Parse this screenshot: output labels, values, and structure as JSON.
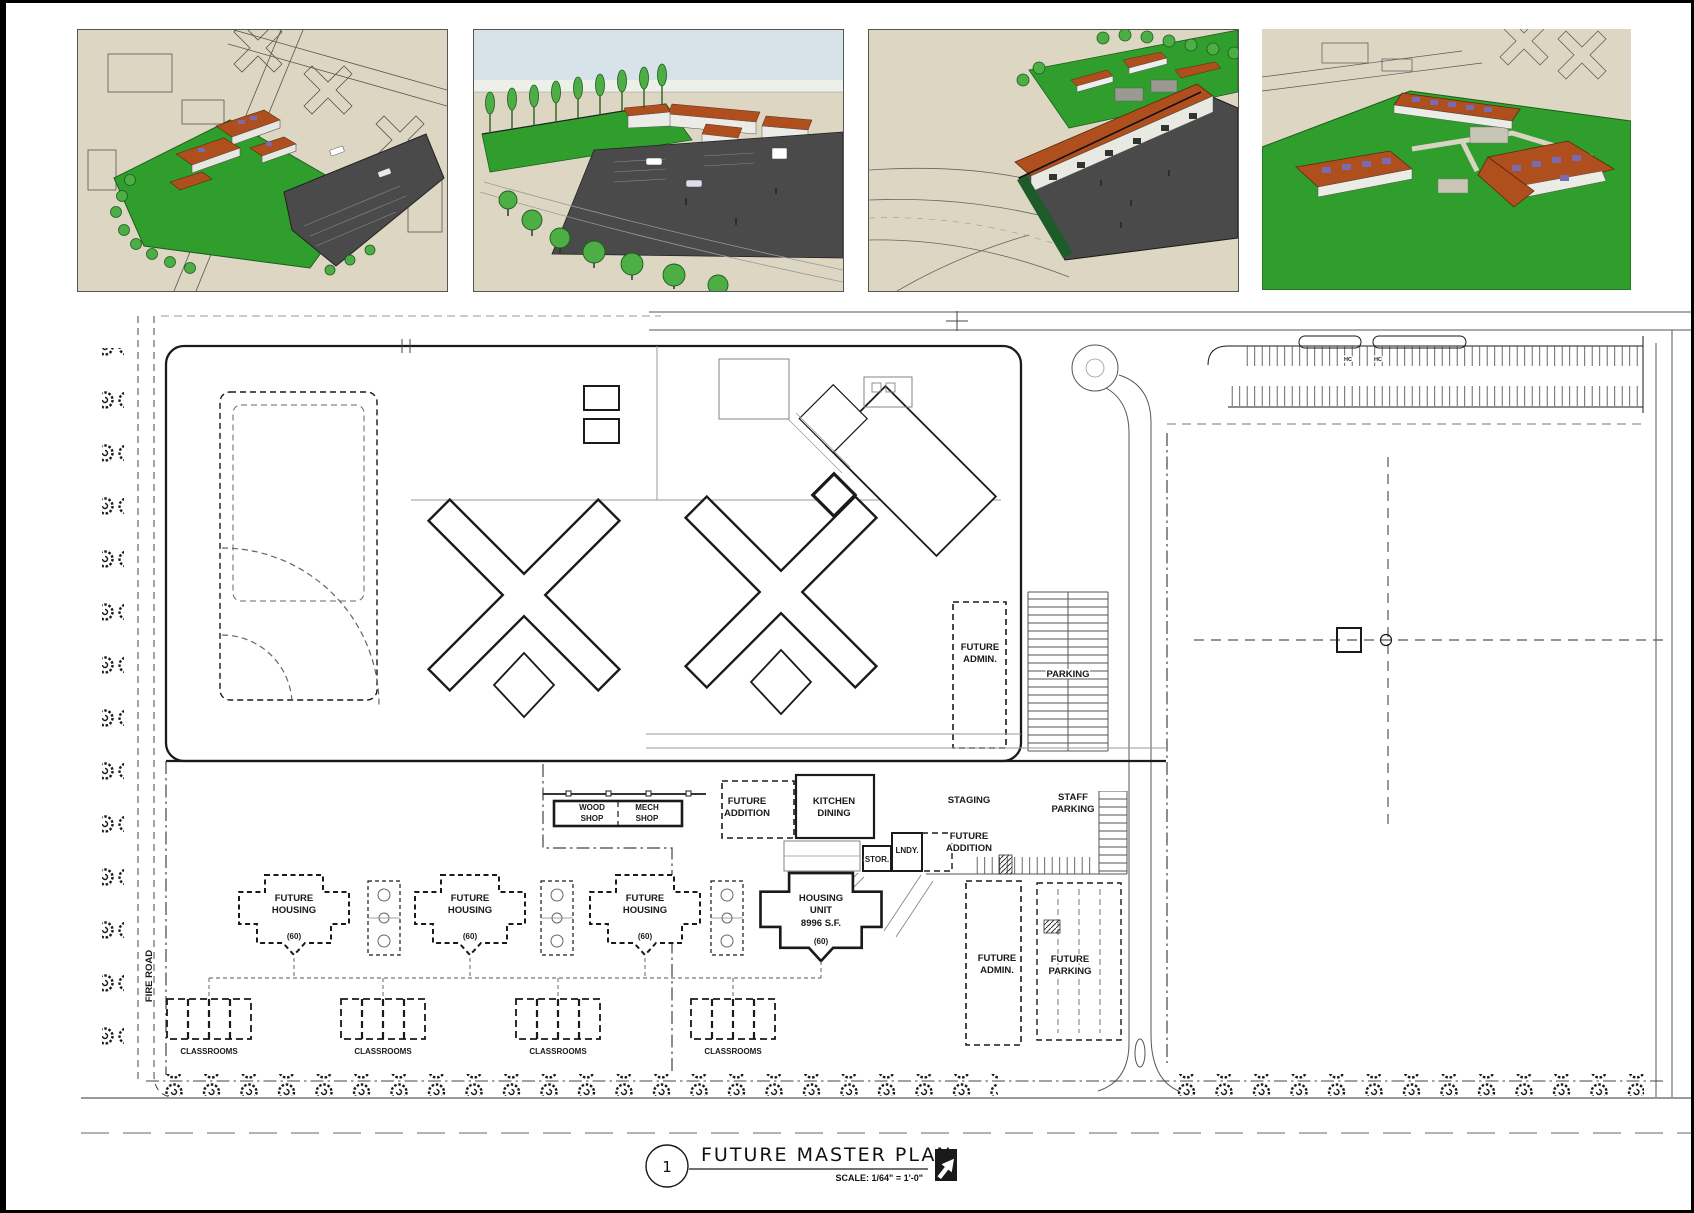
{
  "title_block": {
    "sheet_number": "1",
    "title": "FUTURE MASTER PLAN",
    "scale": "SCALE: 1/64\" = 1'-0\""
  },
  "plan": {
    "words": {
      "future": "FUTURE",
      "admin": "ADMIN.",
      "parking": "PARKING",
      "wood": "WOOD",
      "mech": "MECH",
      "shop": "SHOP",
      "addition": "ADDITION",
      "kitchen": "KITCHEN",
      "dining": "DINING",
      "staging": "STAGING",
      "staff": "STAFF",
      "laundry": "LNDY.",
      "storage": "STOR.",
      "housing": "HOUSING",
      "unit": "UNIT",
      "area_sf": "8996 S.F.",
      "capacity": "(60)",
      "classrooms": "CLASSROOMS",
      "handicap": "HC",
      "fire_road": "FIRE ROAD"
    }
  },
  "colors": {
    "paper": "#ffffff",
    "ink": "#1a1a1a",
    "ground_beige": "#dcd6c2",
    "grass": "#2f9e2c",
    "roof": "#b04f1e",
    "asphalt": "#4a4a4a",
    "tree_green": "#4cae45",
    "sky": "#d7e3e8",
    "solar": "#7a6ab0"
  }
}
